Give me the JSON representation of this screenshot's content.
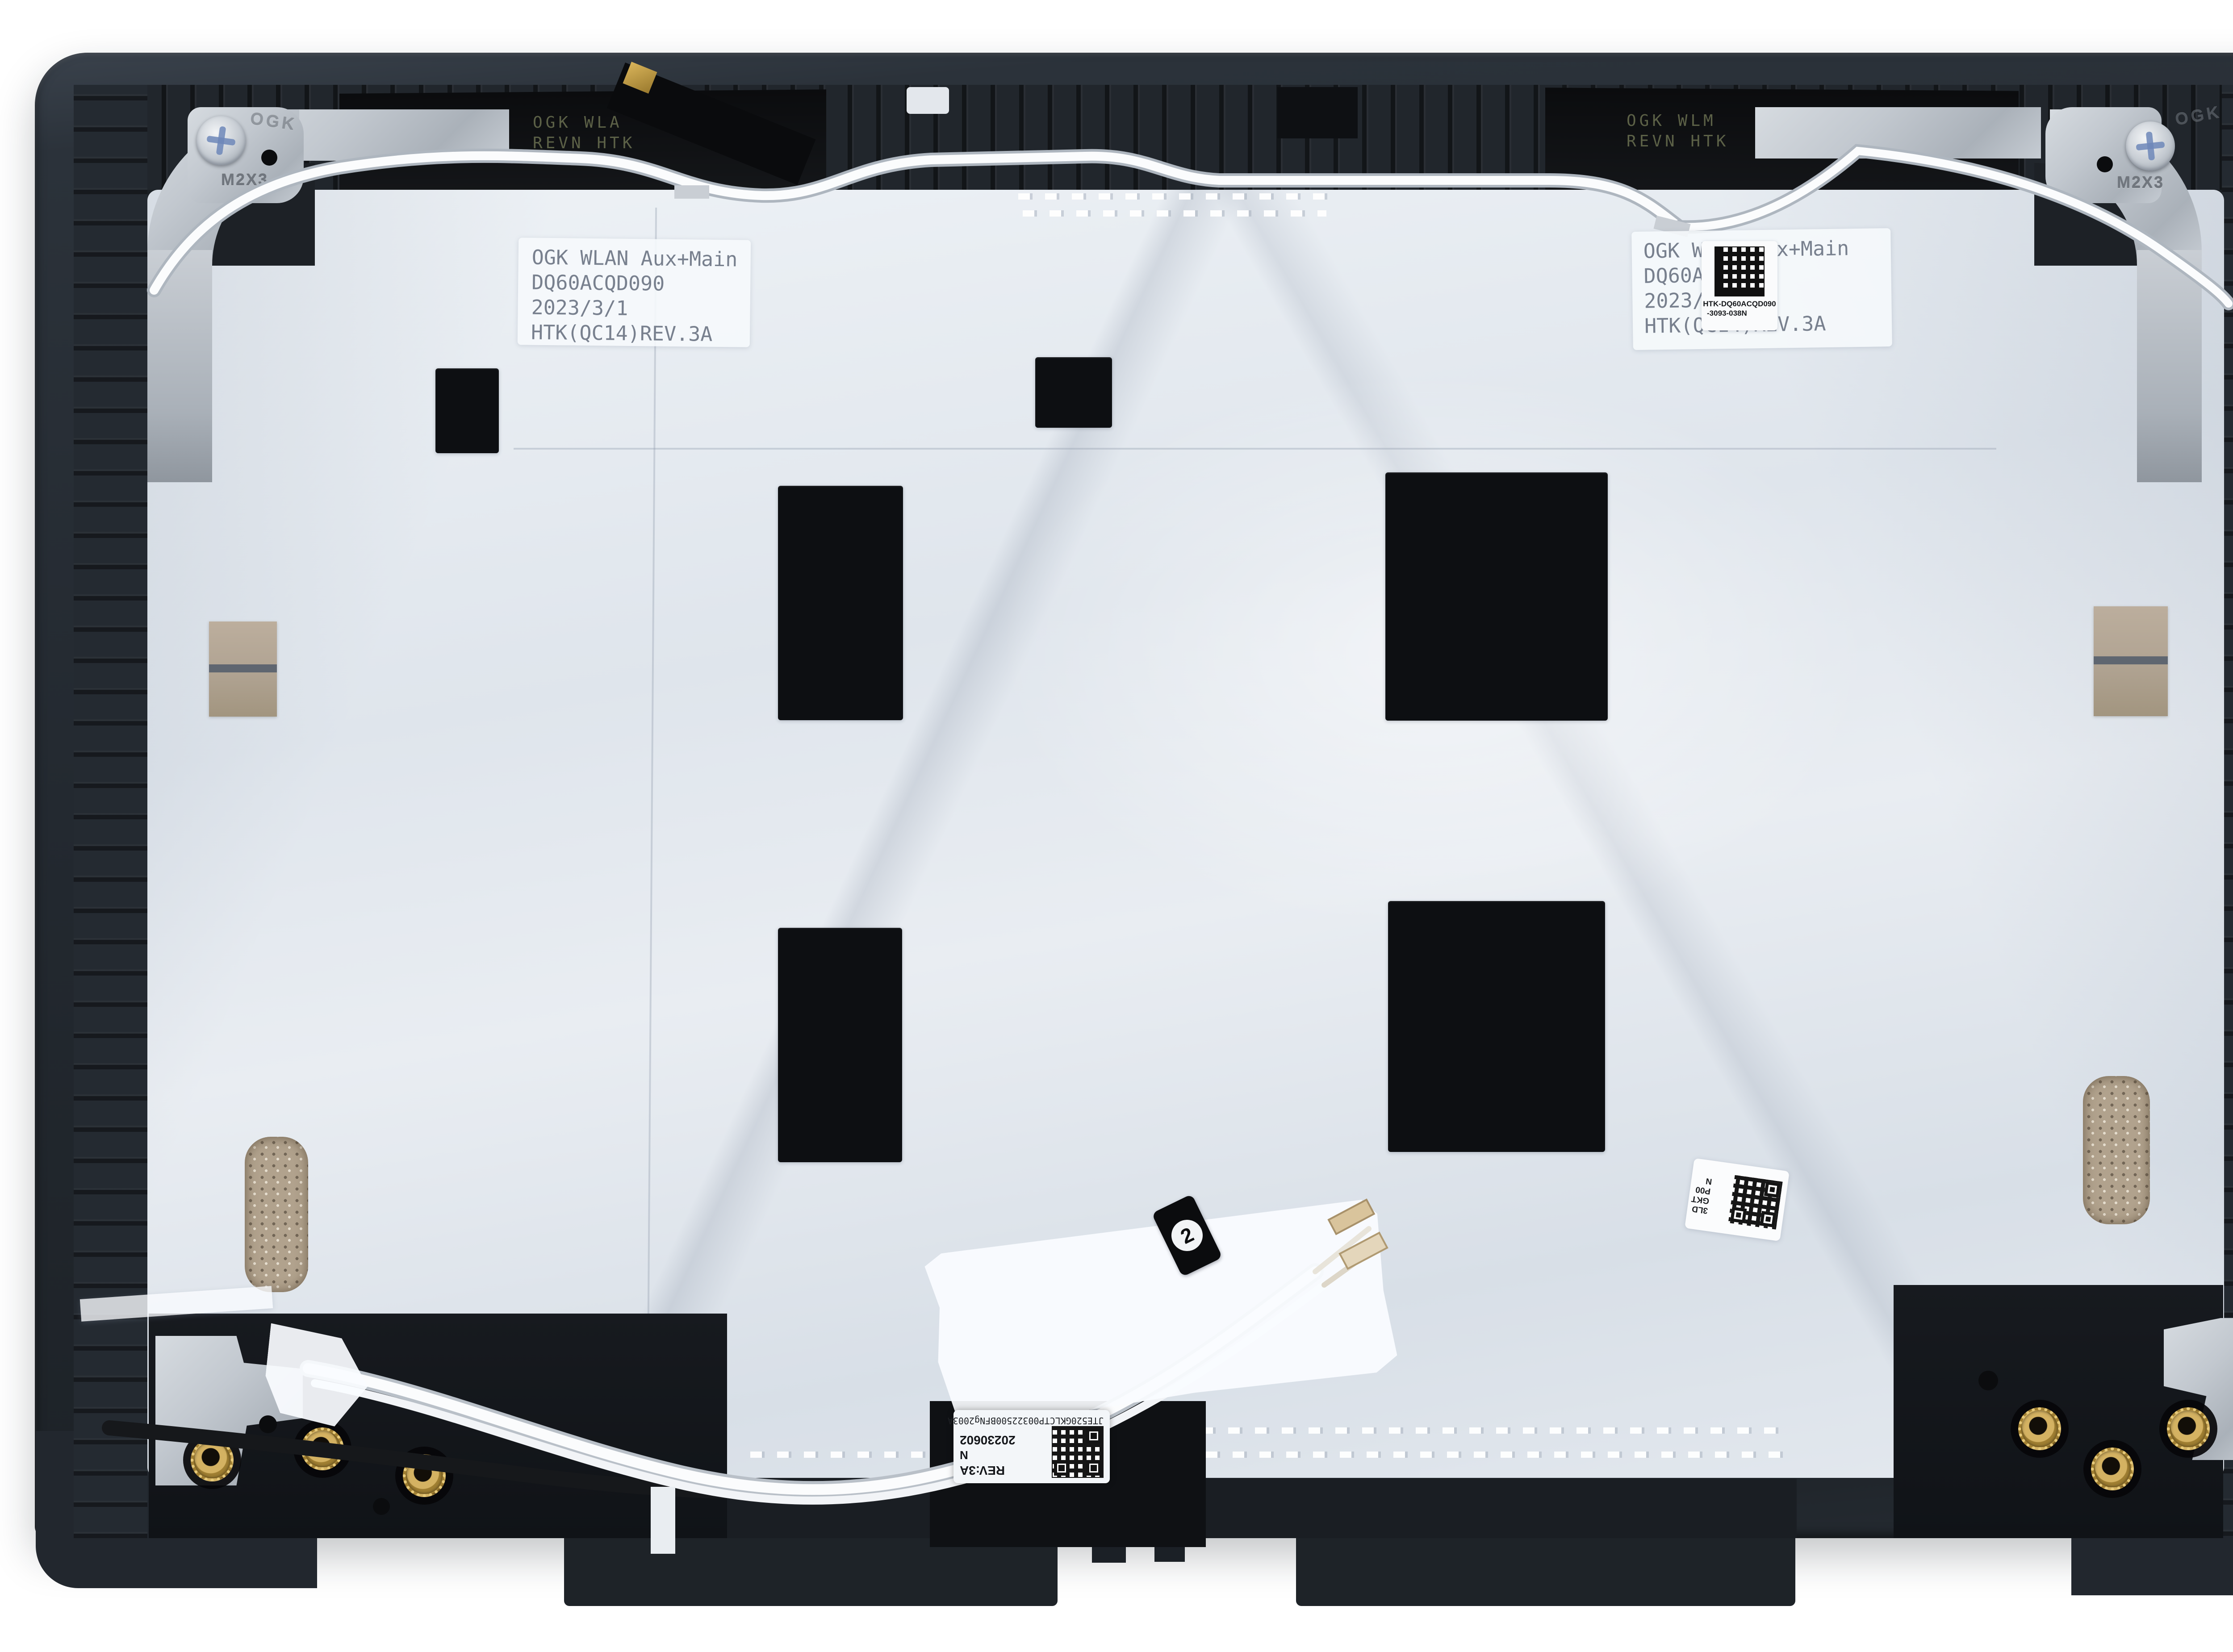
{
  "frame": {
    "embossed_left": "OGK",
    "embossed_right": "OGK",
    "screw_size_left": "M2X3",
    "screw_size_right": "M2X3"
  },
  "labels": {
    "top_left": {
      "line1": "OGK WLAN Aux+Main",
      "line2": "DQ60ACQD090",
      "line3": "2023/3/1",
      "line4": "HTK(QC14)REV.3A"
    },
    "top_right": {
      "line1": "OGK WLAN Aux+Main",
      "line2": "DQ60ACQD090",
      "line3": "2023/3/1",
      "line4": "HTK(QC14)REV.3A"
    },
    "top_right_sticker": {
      "line1": "HTK-DQ60ACQD090",
      "line2": "-3093-038N"
    },
    "bottom": {
      "serial": "JTE520GKLCTP00322500BFNg2003A",
      "date": "20230602",
      "grade": "N",
      "revision": "REV:3A"
    },
    "side_qr": {
      "line1": "3LD",
      "line2": "GKT",
      "line3": "P00",
      "line4": "N"
    }
  },
  "antenna": {
    "left_line1": "OGK WLA",
    "left_line2": "REVN HTK",
    "right_line1": "OGK WLM",
    "right_line2": "REVN HTK"
  },
  "cable_tag": {
    "number": "2"
  },
  "colors": {
    "frame": "#2b323a",
    "foil": "#e3e8ee",
    "absorber_pad": "#0d0f12",
    "brass_insert": "#c09a45",
    "foam_pad": "#b1a28d",
    "tape": "#fafcff",
    "screw_cross": "#6d87b8"
  }
}
